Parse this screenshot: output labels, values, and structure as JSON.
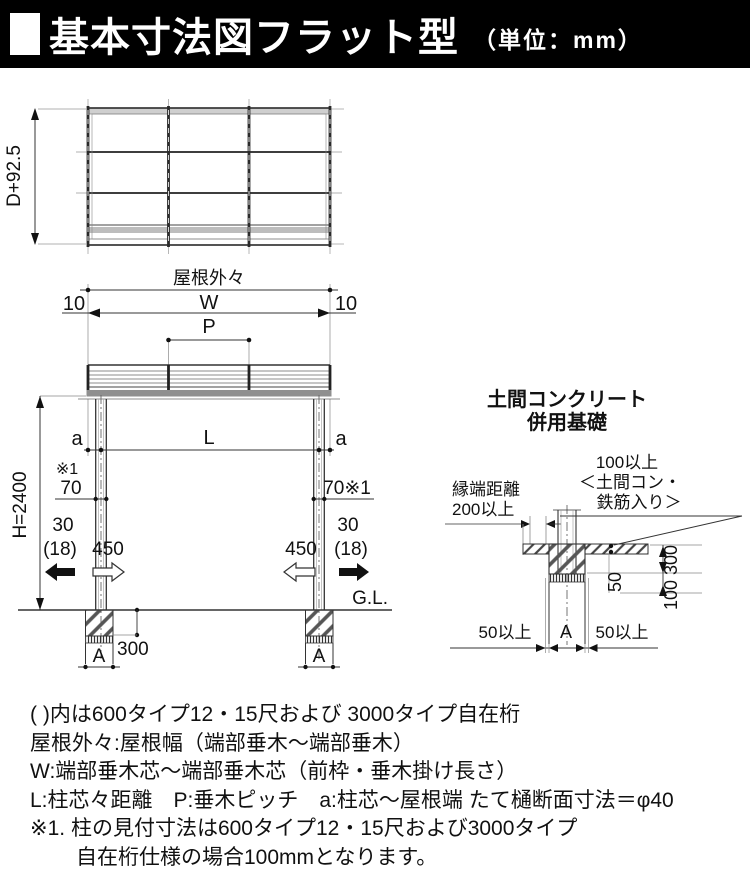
{
  "header": {
    "title": "基本寸法図フラット型",
    "unit": "（単位：mm）",
    "bar_color": "#000000",
    "text_color": "#ffffff"
  },
  "plan": {
    "depth_dim": "D+92.5"
  },
  "elev": {
    "roof_outer": "屋根外々",
    "dim_w": "W",
    "dim_p": "P",
    "dim_l": "L",
    "offset_left": "10",
    "offset_right": "10",
    "a_left": "a",
    "a_right": "a",
    "height": "H=2400",
    "note_ref_left": "※1",
    "col_face_left": "70",
    "col_face_right": "70※1",
    "embed_left": "30",
    "embed_left_paren": "(18)",
    "anchor_left": "450",
    "anchor_right": "450",
    "embed_right": "30",
    "embed_right_paren": "(18)",
    "ground": "G.L.",
    "footing_depth": "300",
    "footing_a_left": "A",
    "footing_a_right": "A"
  },
  "detail": {
    "title_1": "土間コンクリート",
    "title_2": "併用基礎",
    "edge_1": "縁端距離",
    "edge_2": "200以上",
    "slab_1": "100以上",
    "slab_2": "＜土間コン・",
    "slab_3": "鉄筋入り＞",
    "dim_300": "300",
    "dim_100": "100",
    "dim_50": "50",
    "min50_left": "50以上",
    "dim_a": "A",
    "min50_right": "50以上"
  },
  "notes": {
    "lines": [
      "( )内は600タイプ12・15尺および 3000タイプ自在桁",
      "屋根外々:屋根幅（端部垂木～端部垂木）",
      "W:端部垂木芯～端部垂木芯（前枠・垂木掛け長さ）",
      "L:柱芯々距離　P:垂木ピッチ　a:柱芯～屋根端 たて樋断面寸法＝φ40",
      "※1. 柱の見付寸法は600タイプ12・15尺および3000タイプ",
      "自在桁仕様の場合100mmとなります。"
    ]
  }
}
